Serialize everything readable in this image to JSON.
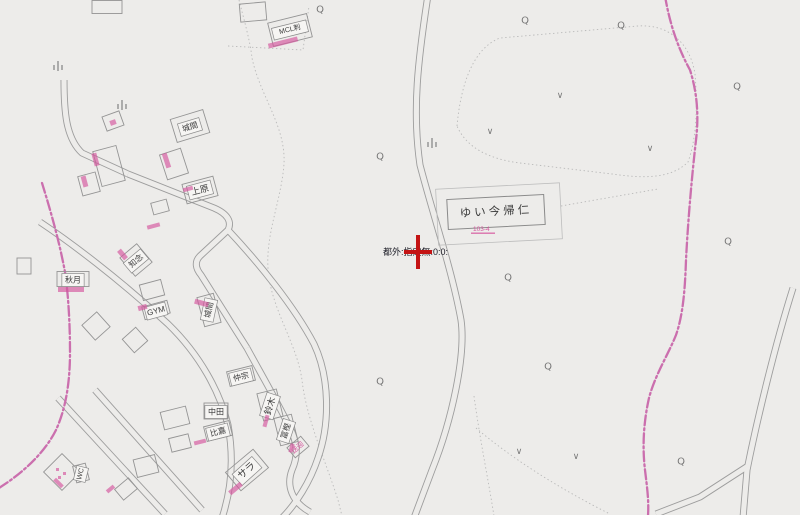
{
  "status": {
    "text": "都外:指定無:0:0:"
  },
  "colors": {
    "background": "#edecea",
    "road_line": "#9d9d9d",
    "dotted_line": "#b9b9b9",
    "parcel_line": "#bdbdbd",
    "building_line": "#949494",
    "label_text": "#3b3b3b",
    "label_box_fill": "#f6f5f3",
    "label_box_line": "#8a8a8a",
    "pink_boundary": "#cb6fae",
    "pink_annotation": "#d4549c",
    "marker_red": "#c41414",
    "symbol_gray": "#787878"
  },
  "map": {
    "width": 800,
    "height": 515,
    "marker": {
      "x": 418,
      "y": 252
    },
    "roads": [
      {
        "name": "center-road",
        "d": "M428,-5 C418,60 412,110 420,165 C433,215 452,270 461,320 C466,355 452,420 432,470 L414,518"
      },
      {
        "name": "right-road",
        "d": "M793,288 C775,345 757,420 747,470 L743,518"
      },
      {
        "name": "right-road-branch",
        "d": "M748,466 L700,497 L656,514"
      },
      {
        "name": "left-top-road",
        "d": "M64,80 C64,112 66,138 82,153 L128,174"
      },
      {
        "name": "zigzag-road",
        "d": "M128,174 L214,208 C228,214 232,222 228,230 L200,256 C194,262 196,269 201,275 L247,348"
      },
      {
        "name": "east-cluster-road",
        "d": "M228,230 C258,262 294,306 314,344 C330,378 330,424 318,458 C310,482 296,504 282,518"
      },
      {
        "name": "inner-cluster-road",
        "d": "M247,348 C260,372 274,396 286,420 C296,438 300,452 292,470 C286,486 292,502 310,512"
      },
      {
        "name": "long-diagonal-road",
        "d": "M40,222 C70,242 118,278 168,324 C200,355 220,392 228,425 C234,458 232,488 222,518"
      },
      {
        "name": "bottom-left-road-1",
        "d": "M58,398 L165,514"
      },
      {
        "name": "bottom-left-road-2",
        "d": "M95,390 L202,510"
      }
    ],
    "pink_lines": [
      {
        "name": "east-boundary",
        "d": "M665,-4 C670,25 678,48 690,70 C697,92 699,115 696,140 C692,175 688,220 686,260 C685,290 683,315 676,335 C668,355 655,375 649,398 C644,420 642,445 645,470 C647,487 649,500 648,516"
      },
      {
        "name": "west-boundary",
        "d": "M42,183 C52,215 60,245 65,272 C69,300 70,330 70,352 C70,382 66,408 56,430 C46,450 28,468 8,482 L-4,490"
      }
    ],
    "dotted_lines": [
      {
        "d": "M238,-4 C244,20 250,40 252,58 C260,96 286,126 284,164 C281,204 263,238 269,278 C275,315 297,345 302,380 C306,418 326,462 338,500 L342,516"
      },
      {
        "d": "M228,46 L303,50 L309,6"
      },
      {
        "d": "M457,126 C461,82 474,48 500,38 L638,26 C668,24 690,42 695,74 C698,110 696,140 688,162 C670,180 640,178 612,174 L520,163 C488,159 466,147 457,126 Z"
      },
      {
        "d": "M561,206 L658,189"
      },
      {
        "d": "M474,396 C480,440 488,478 494,516"
      },
      {
        "d": "M476,428 C516,462 566,492 610,514"
      }
    ],
    "buildings": [
      {
        "cx": 107,
        "cy": 7,
        "w": 30,
        "h": 13,
        "r": 0
      },
      {
        "cx": 253,
        "cy": 12,
        "w": 26,
        "h": 18,
        "r": -5
      },
      {
        "cx": 290,
        "cy": 30,
        "w": 40,
        "h": 24,
        "r": -14
      },
      {
        "cx": 113,
        "cy": 121,
        "w": 18,
        "h": 15,
        "r": -20
      },
      {
        "cx": 190,
        "cy": 126,
        "w": 34,
        "h": 24,
        "r": -17
      },
      {
        "cx": 109,
        "cy": 166,
        "w": 24,
        "h": 36,
        "r": -15
      },
      {
        "cx": 89,
        "cy": 184,
        "w": 18,
        "h": 20,
        "r": -15
      },
      {
        "cx": 174,
        "cy": 164,
        "w": 22,
        "h": 26,
        "r": -18
      },
      {
        "cx": 160,
        "cy": 207,
        "w": 16,
        "h": 12,
        "r": -15
      },
      {
        "cx": 200,
        "cy": 190,
        "w": 32,
        "h": 20,
        "r": -15
      },
      {
        "cx": 24,
        "cy": 266,
        "w": 14,
        "h": 16,
        "r": 0
      },
      {
        "cx": 136,
        "cy": 260,
        "w": 22,
        "h": 24,
        "r": -40
      },
      {
        "cx": 73,
        "cy": 279,
        "w": 32,
        "h": 15,
        "r": 0
      },
      {
        "cx": 152,
        "cy": 290,
        "w": 22,
        "h": 16,
        "r": -15
      },
      {
        "cx": 156,
        "cy": 310,
        "w": 26,
        "h": 13,
        "r": -15
      },
      {
        "cx": 209,
        "cy": 310,
        "w": 17,
        "h": 30,
        "r": -15
      },
      {
        "cx": 96,
        "cy": 326,
        "w": 20,
        "h": 20,
        "r": -42
      },
      {
        "cx": 135,
        "cy": 340,
        "w": 18,
        "h": 18,
        "r": -42
      },
      {
        "cx": 241,
        "cy": 376,
        "w": 26,
        "h": 15,
        "r": -14
      },
      {
        "cx": 270,
        "cy": 405,
        "w": 20,
        "h": 28,
        "r": -14
      },
      {
        "cx": 216,
        "cy": 411,
        "w": 24,
        "h": 16,
        "r": 0
      },
      {
        "cx": 218,
        "cy": 431,
        "w": 26,
        "h": 15,
        "r": -14
      },
      {
        "cx": 286,
        "cy": 430,
        "w": 18,
        "h": 28,
        "r": -14
      },
      {
        "cx": 175,
        "cy": 418,
        "w": 26,
        "h": 18,
        "r": -14
      },
      {
        "cx": 247,
        "cy": 470,
        "w": 36,
        "h": 24,
        "r": -40
      },
      {
        "cx": 298,
        "cy": 447,
        "w": 18,
        "h": 13,
        "r": -40
      },
      {
        "cx": 62,
        "cy": 472,
        "w": 26,
        "h": 26,
        "r": 45
      },
      {
        "cx": 81,
        "cy": 473,
        "w": 13,
        "h": 17,
        "r": -14
      },
      {
        "cx": 126,
        "cy": 489,
        "w": 18,
        "h": 14,
        "r": -40
      },
      {
        "cx": 146,
        "cy": 466,
        "w": 22,
        "h": 18,
        "r": -14
      },
      {
        "cx": 180,
        "cy": 443,
        "w": 20,
        "h": 14,
        "r": -14
      }
    ],
    "main_building": {
      "label": "ゆい今帰仁",
      "sub_label": "103-4",
      "parcel": {
        "cx": 499,
        "cy": 214,
        "w": 124,
        "h": 56,
        "r": -3
      },
      "outline": {
        "cx": 496,
        "cy": 212,
        "w": 97,
        "h": 30,
        "r": -3
      },
      "label_pos": {
        "x": 496,
        "y": 212
      },
      "sub_label_pos": {
        "x": 473,
        "y": 231
      }
    },
    "labels": [
      {
        "text": "城間",
        "x": 190,
        "y": 127,
        "r": -17,
        "fs": 8,
        "boxed": true
      },
      {
        "text": "上原",
        "x": 200,
        "y": 190,
        "r": -15,
        "fs": 9,
        "boxed": true
      },
      {
        "text": "知念",
        "x": 136,
        "y": 261,
        "r": -40,
        "fs": 8,
        "boxed": true
      },
      {
        "text": "秋月",
        "x": 73,
        "y": 280,
        "r": 0,
        "fs": 8,
        "boxed": true
      },
      {
        "text": "GYM",
        "x": 156,
        "y": 311,
        "r": -15,
        "fs": 8,
        "boxed": true
      },
      {
        "text": "城間",
        "x": 209,
        "y": 310,
        "r": -78,
        "fs": 8,
        "boxed": true
      },
      {
        "text": "仲宗",
        "x": 241,
        "y": 377,
        "r": -14,
        "fs": 8,
        "boxed": true
      },
      {
        "text": "鈴木",
        "x": 270,
        "y": 406,
        "r": -72,
        "fs": 9,
        "boxed": true
      },
      {
        "text": "中田",
        "x": 216,
        "y": 412,
        "r": 0,
        "fs": 8,
        "boxed": true
      },
      {
        "text": "比嘉",
        "x": 218,
        "y": 432,
        "r": -14,
        "fs": 8,
        "boxed": true
      },
      {
        "text": "冨樫",
        "x": 286,
        "y": 431,
        "r": -72,
        "fs": 8,
        "boxed": true
      },
      {
        "text": "サラ",
        "x": 247,
        "y": 471,
        "r": -42,
        "fs": 10,
        "boxed": true
      },
      {
        "text": "WC",
        "x": 81,
        "y": 474,
        "r": -76,
        "fs": 7,
        "boxed": true
      },
      {
        "text": "MCL刺",
        "x": 290,
        "y": 30,
        "r": -14,
        "fs": 7,
        "boxed": true
      },
      {
        "text": "送迎",
        "x": 298,
        "y": 448,
        "r": -42,
        "fs": 7,
        "boxed": false,
        "pink": true
      }
    ],
    "pink_marks": [
      [
        58,
        287,
        26,
        5,
        0
      ],
      [
        268,
        40,
        30,
        5,
        -14
      ],
      [
        93,
        153,
        5,
        13,
        -15
      ],
      [
        82,
        176,
        5,
        11,
        -15
      ],
      [
        164,
        153,
        5,
        15,
        -18
      ],
      [
        147,
        224,
        13,
        4,
        -15
      ],
      [
        183,
        187,
        10,
        4,
        -15
      ],
      [
        120,
        249,
        5,
        11,
        -40
      ],
      [
        199,
        296,
        5,
        14,
        -75
      ],
      [
        138,
        305,
        9,
        5,
        -15
      ],
      [
        260,
        419,
        12,
        4,
        -75
      ],
      [
        287,
        446,
        9,
        4,
        -75
      ],
      [
        194,
        440,
        12,
        4,
        -14
      ],
      [
        228,
        486,
        15,
        5,
        -40
      ],
      [
        106,
        487,
        9,
        4,
        -40
      ],
      [
        53,
        481,
        11,
        4,
        45
      ],
      [
        110,
        120,
        6,
        5,
        -20
      ],
      [
        56,
        468,
        3,
        3,
        0
      ],
      [
        63,
        472,
        3,
        3,
        0
      ],
      [
        58,
        476,
        3,
        3,
        0
      ]
    ],
    "symbols": {
      "trees": [
        [
          320,
          10
        ],
        [
          525,
          21
        ],
        [
          621,
          26
        ],
        [
          737,
          87
        ],
        [
          380,
          157
        ],
        [
          728,
          242
        ],
        [
          508,
          278
        ],
        [
          548,
          367
        ],
        [
          380,
          382
        ],
        [
          681,
          462
        ]
      ],
      "fields": [
        [
          560,
          95
        ],
        [
          490,
          131
        ],
        [
          650,
          148
        ],
        [
          519,
          451
        ],
        [
          576,
          456
        ]
      ],
      "bamboo": [
        [
          58,
          68
        ],
        [
          122,
          107
        ],
        [
          432,
          145
        ]
      ]
    }
  }
}
